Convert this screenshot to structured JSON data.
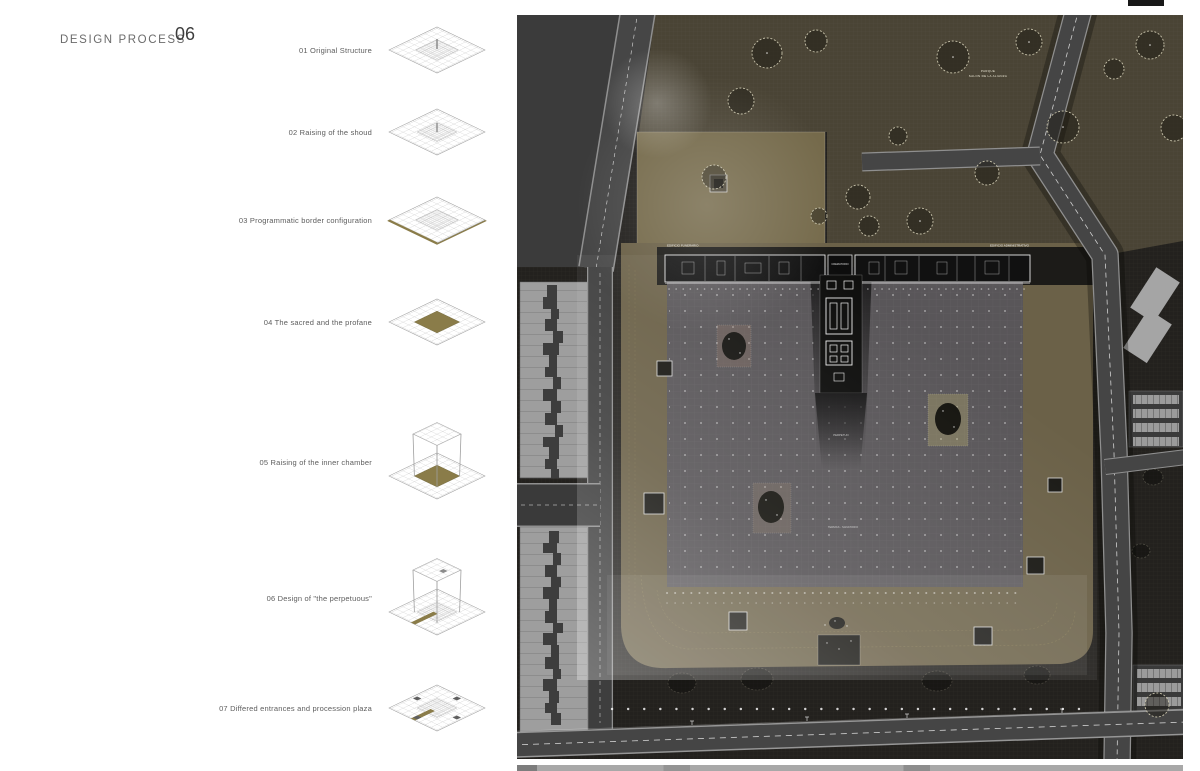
{
  "header": {
    "title": "DESIGN PROCESS",
    "number": "06"
  },
  "steps": [
    {
      "label": "01 Original Structure"
    },
    {
      "label": "02 Raising of the shoud"
    },
    {
      "label": "03 Programmatic border configuration"
    },
    {
      "label": "04 The sacred and the profane"
    },
    {
      "label": "05 Raising of the inner chamber"
    },
    {
      "label": "06 Design of \"the perpetuous\""
    },
    {
      "label": "07 Differed entrances and procession plaza"
    }
  ],
  "plan": {
    "labels": {
      "park_line1": "PARQUE",
      "park_line2": "SALON DE LA ALIANZA",
      "building_left": "EDIFICIO FUNERARIO",
      "building_center": "CREMATORIO",
      "building_right": "EDIFICIO ADMINISTRATIVO",
      "plaza_center": "PERPETUO",
      "plaza_lower": "TERMAS - SANATORIO"
    },
    "colors": {
      "ground": "#23211e",
      "park": "#4a4435",
      "khaki_field": "#6b6148",
      "khaki_light": "#756a4b",
      "plaza": "#595659",
      "road": "#454545",
      "city_block": "#9e9e9e",
      "diagram_accent": "#8a7c49"
    }
  }
}
